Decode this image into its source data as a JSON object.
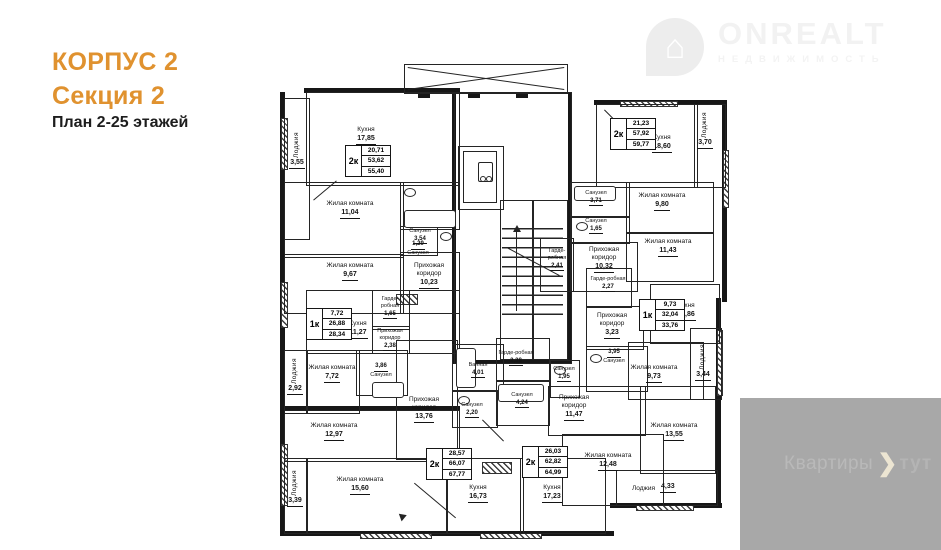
{
  "header": {
    "building": "КОРПУС 2",
    "section": "Секция 2",
    "plan_title": "План 2-25 этажей"
  },
  "brand": {
    "name": "ONREALT",
    "tagline": "НЕДВИЖИМОСТЬ"
  },
  "footer_watermark": {
    "left": "Квартиры",
    "chevron": "❯",
    "right": "тут"
  },
  "colors": {
    "accent_orange": "#e0922f",
    "wall_black": "#171717",
    "watermark_gray": "#a8a8a8"
  },
  "apartments": [
    {
      "type": "2к",
      "areas": [
        "20,71",
        "53,62",
        "55,40"
      ],
      "rooms": [
        {
          "label": "Лоджия",
          "area": "3,55"
        },
        {
          "label": "Кухня",
          "area": "17,85"
        },
        {
          "label": "Жилая комната",
          "area": "11,04"
        },
        {
          "label": "Санузел",
          "area": "3,54"
        },
        {
          "label": "Санузел",
          "area": "1,29"
        },
        {
          "label": "Жилая комната",
          "area": "9,67"
        },
        {
          "label": "Прихожая коридор",
          "area": "10,23"
        }
      ]
    },
    {
      "type": "1к",
      "areas": [
        "7,72",
        "26,88",
        "28,34"
      ],
      "rooms": [
        {
          "label": "Гарде-робная",
          "area": "1,65"
        },
        {
          "label": "Кухня",
          "area": "11,27"
        },
        {
          "label": "Прихожая коридор",
          "area": "2,38"
        },
        {
          "label": "Санузел",
          "area": "3,86"
        },
        {
          "label": "Жилая комната",
          "area": "7,72"
        },
        {
          "label": "Лоджия",
          "area": "2,92"
        }
      ]
    },
    {
      "type": "2к",
      "areas": [
        "28,57",
        "66,07",
        "67,77"
      ],
      "rooms": [
        {
          "label": "Жилая комната",
          "area": "12,97"
        },
        {
          "label": "Жилая комната",
          "area": "15,60"
        },
        {
          "label": "Лоджия",
          "area": "3,39"
        },
        {
          "label": "Кухня",
          "area": "16,73"
        },
        {
          "label": "Прихожая коридор",
          "area": "13,76"
        },
        {
          "label": "Ванная",
          "area": "4,01"
        },
        {
          "label": "Санузел",
          "area": "2,20"
        }
      ]
    },
    {
      "type": "2к",
      "areas": [
        "26,03",
        "62,82",
        "64,99"
      ],
      "rooms": [
        {
          "label": "Гарде-робная",
          "area": "2,38"
        },
        {
          "label": "Санузел",
          "area": "4,24"
        },
        {
          "label": "Санузел",
          "area": "1,95"
        },
        {
          "label": "Прихожая коридор",
          "area": "11,47"
        },
        {
          "label": "Кухня",
          "area": "17,23"
        },
        {
          "label": "Жилая комната",
          "area": "12,48"
        },
        {
          "label": "Жилая комната",
          "area": "13,55"
        },
        {
          "label": "Лоджия",
          "area": "4,33"
        }
      ]
    },
    {
      "type": "1к",
      "areas": [
        "9,73",
        "32,04",
        "33,76"
      ],
      "rooms": [
        {
          "label": "Гарде-робная",
          "area": "2,27"
        },
        {
          "label": "Прихожая коридор",
          "area": "3,23"
        },
        {
          "label": "Санузел",
          "area": "3,95"
        },
        {
          "label": "Кухня",
          "area": "12,86"
        },
        {
          "label": "Жилая комната",
          "area": "9,73"
        },
        {
          "label": "Лоджия",
          "area": "3,44"
        }
      ]
    },
    {
      "type": "2к",
      "areas": [
        "21,23",
        "57,92",
        "59,77"
      ],
      "rooms": [
        {
          "label": "Кухня",
          "area": "18,60"
        },
        {
          "label": "Лоджия",
          "area": "3,70"
        },
        {
          "label": "Санузел",
          "area": "3,71"
        },
        {
          "label": "Санузел",
          "area": "1,65"
        },
        {
          "label": "Прихожая коридор",
          "area": "10,32"
        },
        {
          "label": "Гарде-робная",
          "area": "2,41"
        },
        {
          "label": "Жилая комната",
          "area": "9,80"
        },
        {
          "label": "Жилая комната",
          "area": "11,43"
        }
      ]
    }
  ]
}
